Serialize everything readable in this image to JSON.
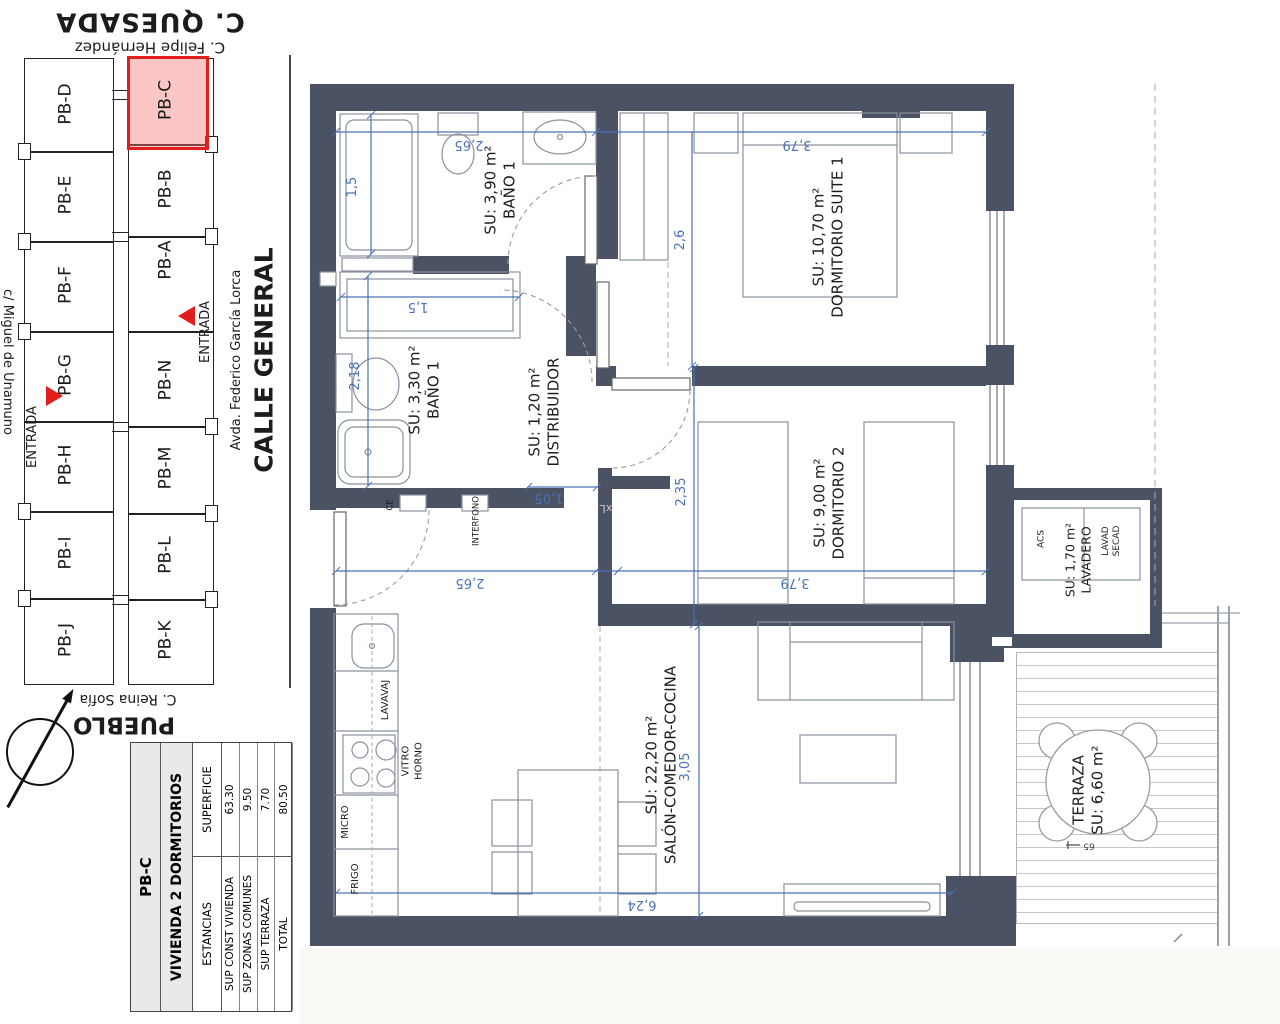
{
  "site_plan": {
    "street_top": "C. QUESADA",
    "street_top_sub": "C. Felipe Hernández",
    "street_left": "c/ Miguel de Unamuno",
    "avenue": "Avda. Federico García Lorca",
    "street_main": "CALLE GENERAL",
    "street_bottom": "C. Reina Sofía",
    "area_bottom": "PUEBLO",
    "entrance_left": "ENTRADA",
    "entrance_right": "ENTRADA",
    "units_col1": [
      "PB-D",
      "PB-E",
      "PB-F",
      "PB-G",
      "PB-H",
      "PB-I",
      "PB-J"
    ],
    "units_col2": [
      "PB-C",
      "PB-B",
      "PB-A",
      "PB-N",
      "PB-M",
      "PB-L",
      "PB-K"
    ],
    "highlighted_unit": "PB-C",
    "highlight_fill": "#f6b6b6",
    "highlight_border": "#e21d1d"
  },
  "summary_table": {
    "unit": "PB-C",
    "type": "VIVIENDA 2 DORMITORIOS",
    "col_rooms": "ESTANCIAS",
    "col_area": "SUPERFICIE",
    "rows": [
      {
        "label": "SUP CONST VIVIENDA",
        "value": "63.30"
      },
      {
        "label": "SUP ZONAS COMUNES",
        "value": "9.50"
      },
      {
        "label": "SUP TERRAZA",
        "value": "7.70"
      },
      {
        "label": "TOTAL",
        "value": "80.50"
      }
    ]
  },
  "floor_plan": {
    "rooms": {
      "bath1": {
        "area": "SU: 3,90 m²",
        "name": "BAÑO 1"
      },
      "suite": {
        "area": "SU: 10,70 m²",
        "name": "DORMITORIO SUITE 1"
      },
      "bath2": {
        "area": "SU: 3,30 m²",
        "name": "BAÑO 1"
      },
      "hall": {
        "area": "SU: 1,20 m²",
        "name": "DISTRIBUIDOR"
      },
      "bedroom2": {
        "area": "SU: 9,00 m²",
        "name": "DORMITORIO 2"
      },
      "living": {
        "area": "SU: 22,20 m²",
        "name": "SALÓN-COMEDOR-COCINA"
      },
      "laundry": {
        "area": "SU: 1,70 m²",
        "name": "LAVADERO"
      },
      "terrace": {
        "name": "TERRAZA",
        "area": "SU: 6,60 m²"
      }
    },
    "appliances": {
      "dishwasher": "LAVAVAJ",
      "hob": "VITRO",
      "oven": "HORNO",
      "micro": "MICRO",
      "fridge": "FRIGO",
      "water_heater": "ACS",
      "washer": "LAVAD",
      "dryer": "SECAD"
    },
    "labels": {
      "intercom": "INTERFONO",
      "electric": "CE",
      "mark": "xL",
      "level": "65"
    },
    "dims": {
      "d265a": "2,65",
      "d379a": "3,79",
      "d15a": "1,5",
      "d26": "2,6",
      "d15b": "1,5",
      "d218": "2,18",
      "d105": "1,05",
      "d235": "2,35",
      "d379b": "3,79",
      "d265b": "2,65",
      "d305": "3,05",
      "d624": "6,24"
    },
    "colors": {
      "wall": "#4a5264",
      "dim": "#4a72b4"
    }
  }
}
